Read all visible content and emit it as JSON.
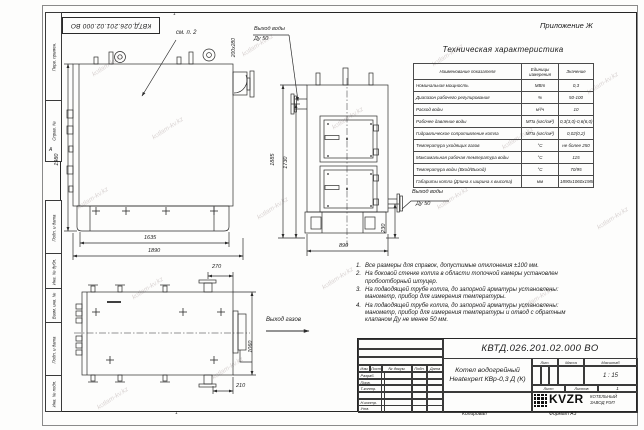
{
  "page": {
    "appendix": "Приложение Ж",
    "watermark": "kotlam-kv.kz",
    "zone_top": "1",
    "zone_bottom": "1",
    "zone_left": "А",
    "copied": "Копировал",
    "format": "Формат А3"
  },
  "margin_labels": [
    "Перв. примен.",
    "Справ. №",
    "Подп. и дата",
    "Инв. № дубл.",
    "Взам. инв. №",
    "Подп. и дата",
    "Инв. № подл."
  ],
  "drawing": {
    "see_note": "см. п. 2",
    "front": {
      "dim_height": "1980",
      "dim_base": "1635",
      "dim_length": "1890",
      "flue_size": "200х280"
    },
    "side": {
      "dim_h_total": "1885",
      "dim_h_outlet": "1730",
      "dim_width": "890",
      "dim_h_inlet": "230",
      "outlet_line1": "Выход воды",
      "outlet_line2": "Ду 50",
      "inlet_line1": "Выход воды",
      "inlet_line2": "Ду 50"
    },
    "plan": {
      "dim_flue_offset": "270",
      "dim_width": "1060",
      "dim_flue_side": "210",
      "gas_outlet": "Выход газов"
    }
  },
  "table": {
    "title": "Техническая характеристика",
    "col_headers": [
      "Наименование показателя",
      "Единицы измерения",
      "Значение"
    ],
    "rows": [
      [
        "Номинальная мощность",
        "МВт",
        "0,3"
      ],
      [
        "Диапазон рабочего регулирования",
        "%",
        "50-100"
      ],
      [
        "Расход воды",
        "м³/ч",
        "10"
      ],
      [
        "Рабочее давление воды",
        "МПа (кгс/см²)",
        "0,3(3,0)-0,6(6,0)"
      ],
      [
        "Гидравлическое сопротивление котла",
        "МПа (кгс/см²)",
        "0,02(0,2)"
      ],
      [
        "Температура уходящих газов",
        "°С",
        "не более 250"
      ],
      [
        "Максимальная рабочая температура воды",
        "°С",
        "115"
      ],
      [
        "Температура воды (Вход/Выход)",
        "°С",
        "70/95"
      ],
      [
        "Габариты котла (Длина х ширина х высота)",
        "мм",
        "1890х1060х1980"
      ]
    ]
  },
  "notes": [
    "Все размеры для справок, допустимые отклонения ±100 мм.",
    "На боковой стенке котла в области топочной камеры установлен пробоотборный штуцер.",
    "На подводящей трубе котла, до запорной арматуры установлены: манометр, прибор для измерения температуры.",
    "На подводящей трубе котла, до запорной арматуры установлены: манометр, прибор для измерения температуры и отвод с обратным клапаном Ду не менее 50 мм."
  ],
  "title_block": {
    "doc_number": "КВТД.026.201.02.000 ВО",
    "name_line1": "Котел водогрейный",
    "name_line2": "Heatexpert КВр-0,3 Д (К)",
    "cols": {
      "izm": "Изм.",
      "list": "Лист",
      "doc": "№ докум.",
      "podp": "Подп.",
      "data": "Дата"
    },
    "sign_rows": [
      "Разраб.",
      "Пров.",
      "Т.контр.",
      "",
      "Н.контр.",
      "Утв."
    ],
    "lit": "Лит.",
    "mass": "Масса",
    "scale": "Масштаб",
    "scale_value": "1 : 15",
    "sheet": "Лист",
    "sheets": "Листов",
    "sheets_value": "1",
    "logo_text": "KVZR",
    "company_line1": "КОТЕЛЬНЫЙ",
    "company_line2": "ЗАВОД РЭП"
  }
}
